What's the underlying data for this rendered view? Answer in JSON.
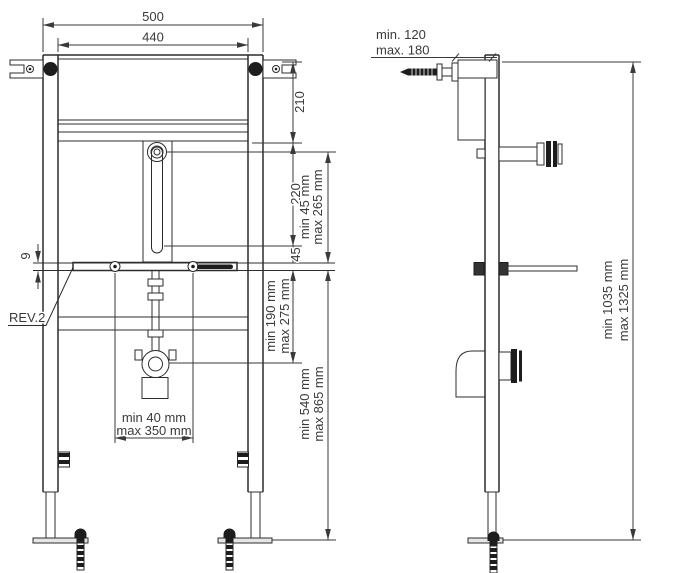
{
  "page": {
    "title": "Washbasin installation frame - dimensional drawing",
    "background": "#ffffff",
    "line_color": "#2c2c2c",
    "dim_color": "#3a3a3a"
  },
  "front_view": {
    "name": "front view",
    "dims": {
      "overall_width": "500",
      "inner_width": "440",
      "top_offset": "210",
      "slot_travel": "220",
      "bar_offset": "45",
      "bar_thickness": "9",
      "tap_height_min": "min 45 mm",
      "tap_height_max": "max 265 mm",
      "drain_height_min": "min 190 mm",
      "drain_height_max": "max 275 mm",
      "bar_floor_min": "min 540 mm",
      "bar_floor_max": "max 865 mm",
      "bolt_spacing_min": "min 40 mm",
      "bolt_spacing_max": "max 350 mm"
    },
    "labels": {
      "revision": "REV.2"
    }
  },
  "side_view": {
    "name": "side view",
    "dims": {
      "wall_distance_min": "min. 120",
      "wall_distance_max": "max. 180",
      "frame_height_min": "min 1035 mm",
      "frame_height_max": "max 1325 mm"
    }
  }
}
